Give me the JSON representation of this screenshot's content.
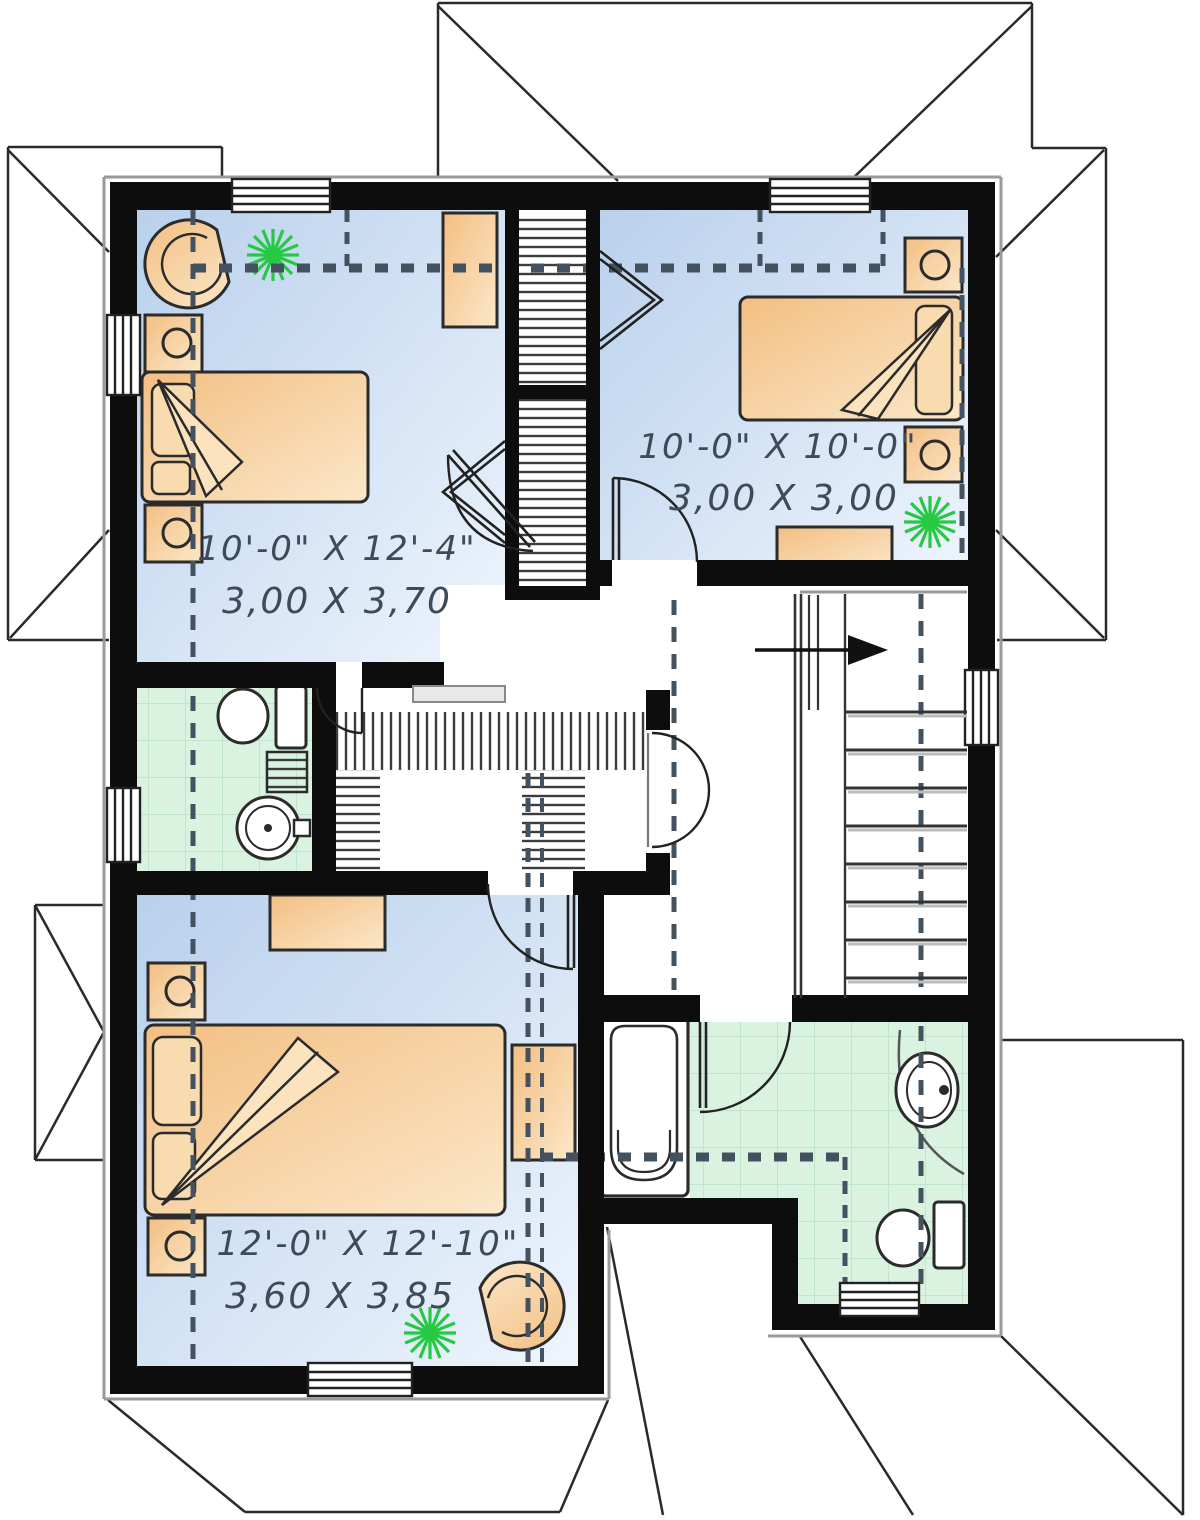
{
  "plan": {
    "type": "floor-plan",
    "floor_color_bedroom": "#c3d7f0",
    "floor_color_bathroom": "#d9f2e0",
    "furniture_color": "#f4c289",
    "wall_color": "#0d0d0d",
    "plant_color": "#25c944",
    "label_color": "#3d4a57"
  },
  "rooms": {
    "bedroom1": {
      "dim_imperial": "10'-0\" X 12'-4\"",
      "dim_metric": "3,00 X 3,70"
    },
    "bedroom2": {
      "dim_imperial": "10'-0\" X 10'-0\"",
      "dim_metric": "3,00 X 3,00"
    },
    "bedroom3": {
      "dim_imperial": "12'-0\" X 12'-10\"",
      "dim_metric": "3,60 X 3,85"
    }
  }
}
